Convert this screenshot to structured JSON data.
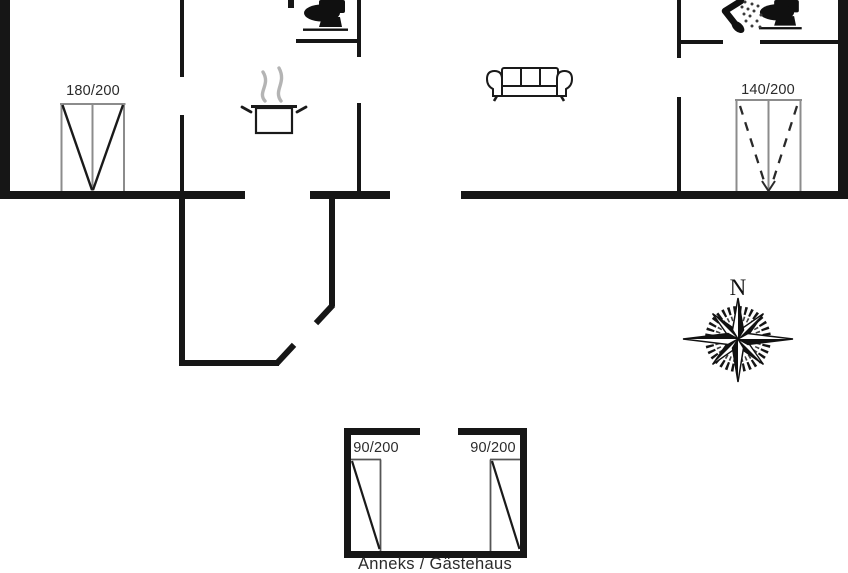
{
  "floor_plan": {
    "type": "holiday-home-floor-plan",
    "labels": {
      "window_left_bedroom": "180/200",
      "window_right_bedroom": "140/200",
      "annex_door_left": "90/200",
      "annex_door_right": "90/200",
      "annex_title": "Anneks / Gästehaus"
    },
    "compass": {
      "north_label": "N"
    },
    "icons": [
      "toilet-icon",
      "shower-icon",
      "cooking-pot-icon",
      "sofa-icon",
      "compass-rose-icon"
    ],
    "colors": {
      "background": "#ffffff",
      "wall": "#161616",
      "window_frame": "#8c8c8c",
      "door_diagonal": "#1a1a1a",
      "steam": "#b4b4b4",
      "label_text": "#2b2b2b"
    }
  }
}
